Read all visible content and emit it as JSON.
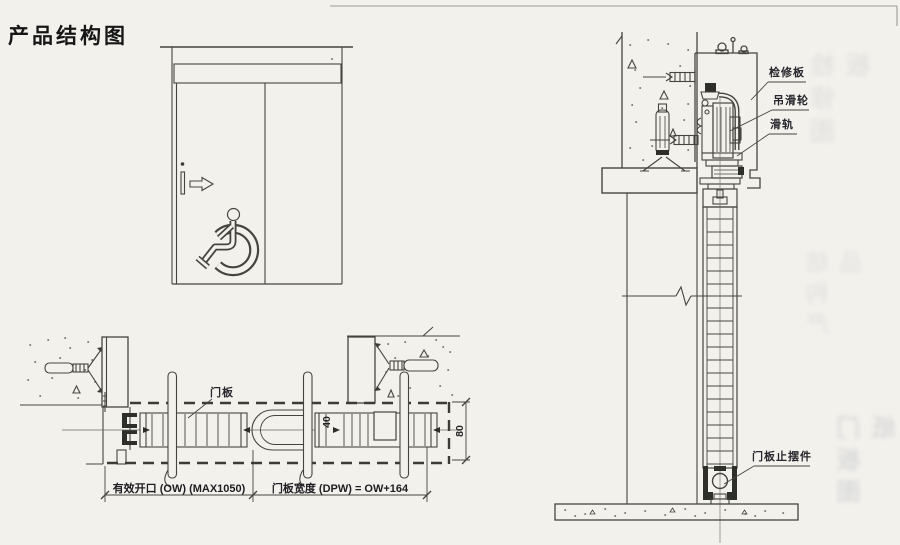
{
  "title": "产品结构图",
  "colors": {
    "paper": "#f3f1ec",
    "line": "#45453f",
    "text": "#22222a"
  },
  "icons": {
    "wheelchair": "wheelchair-accessibility-symbol",
    "arrow": "slide-direction-arrow",
    "anchor": "expansion-anchor-bolt"
  },
  "views": {
    "plan": {
      "door_panel_label": "门板",
      "dim_opening": "有效开口 (OW) (MAX1050)",
      "dim_panel_width": "门板宽度 (DPW) = OW+164",
      "dim_thickness": "40",
      "dim_track_depth": "80"
    },
    "section": {
      "label_inspection_panel": "检修板",
      "label_hanging_roller": "吊滑轮",
      "label_slide_rail": "滑轨",
      "label_door_stop": "门板止摆件"
    }
  }
}
